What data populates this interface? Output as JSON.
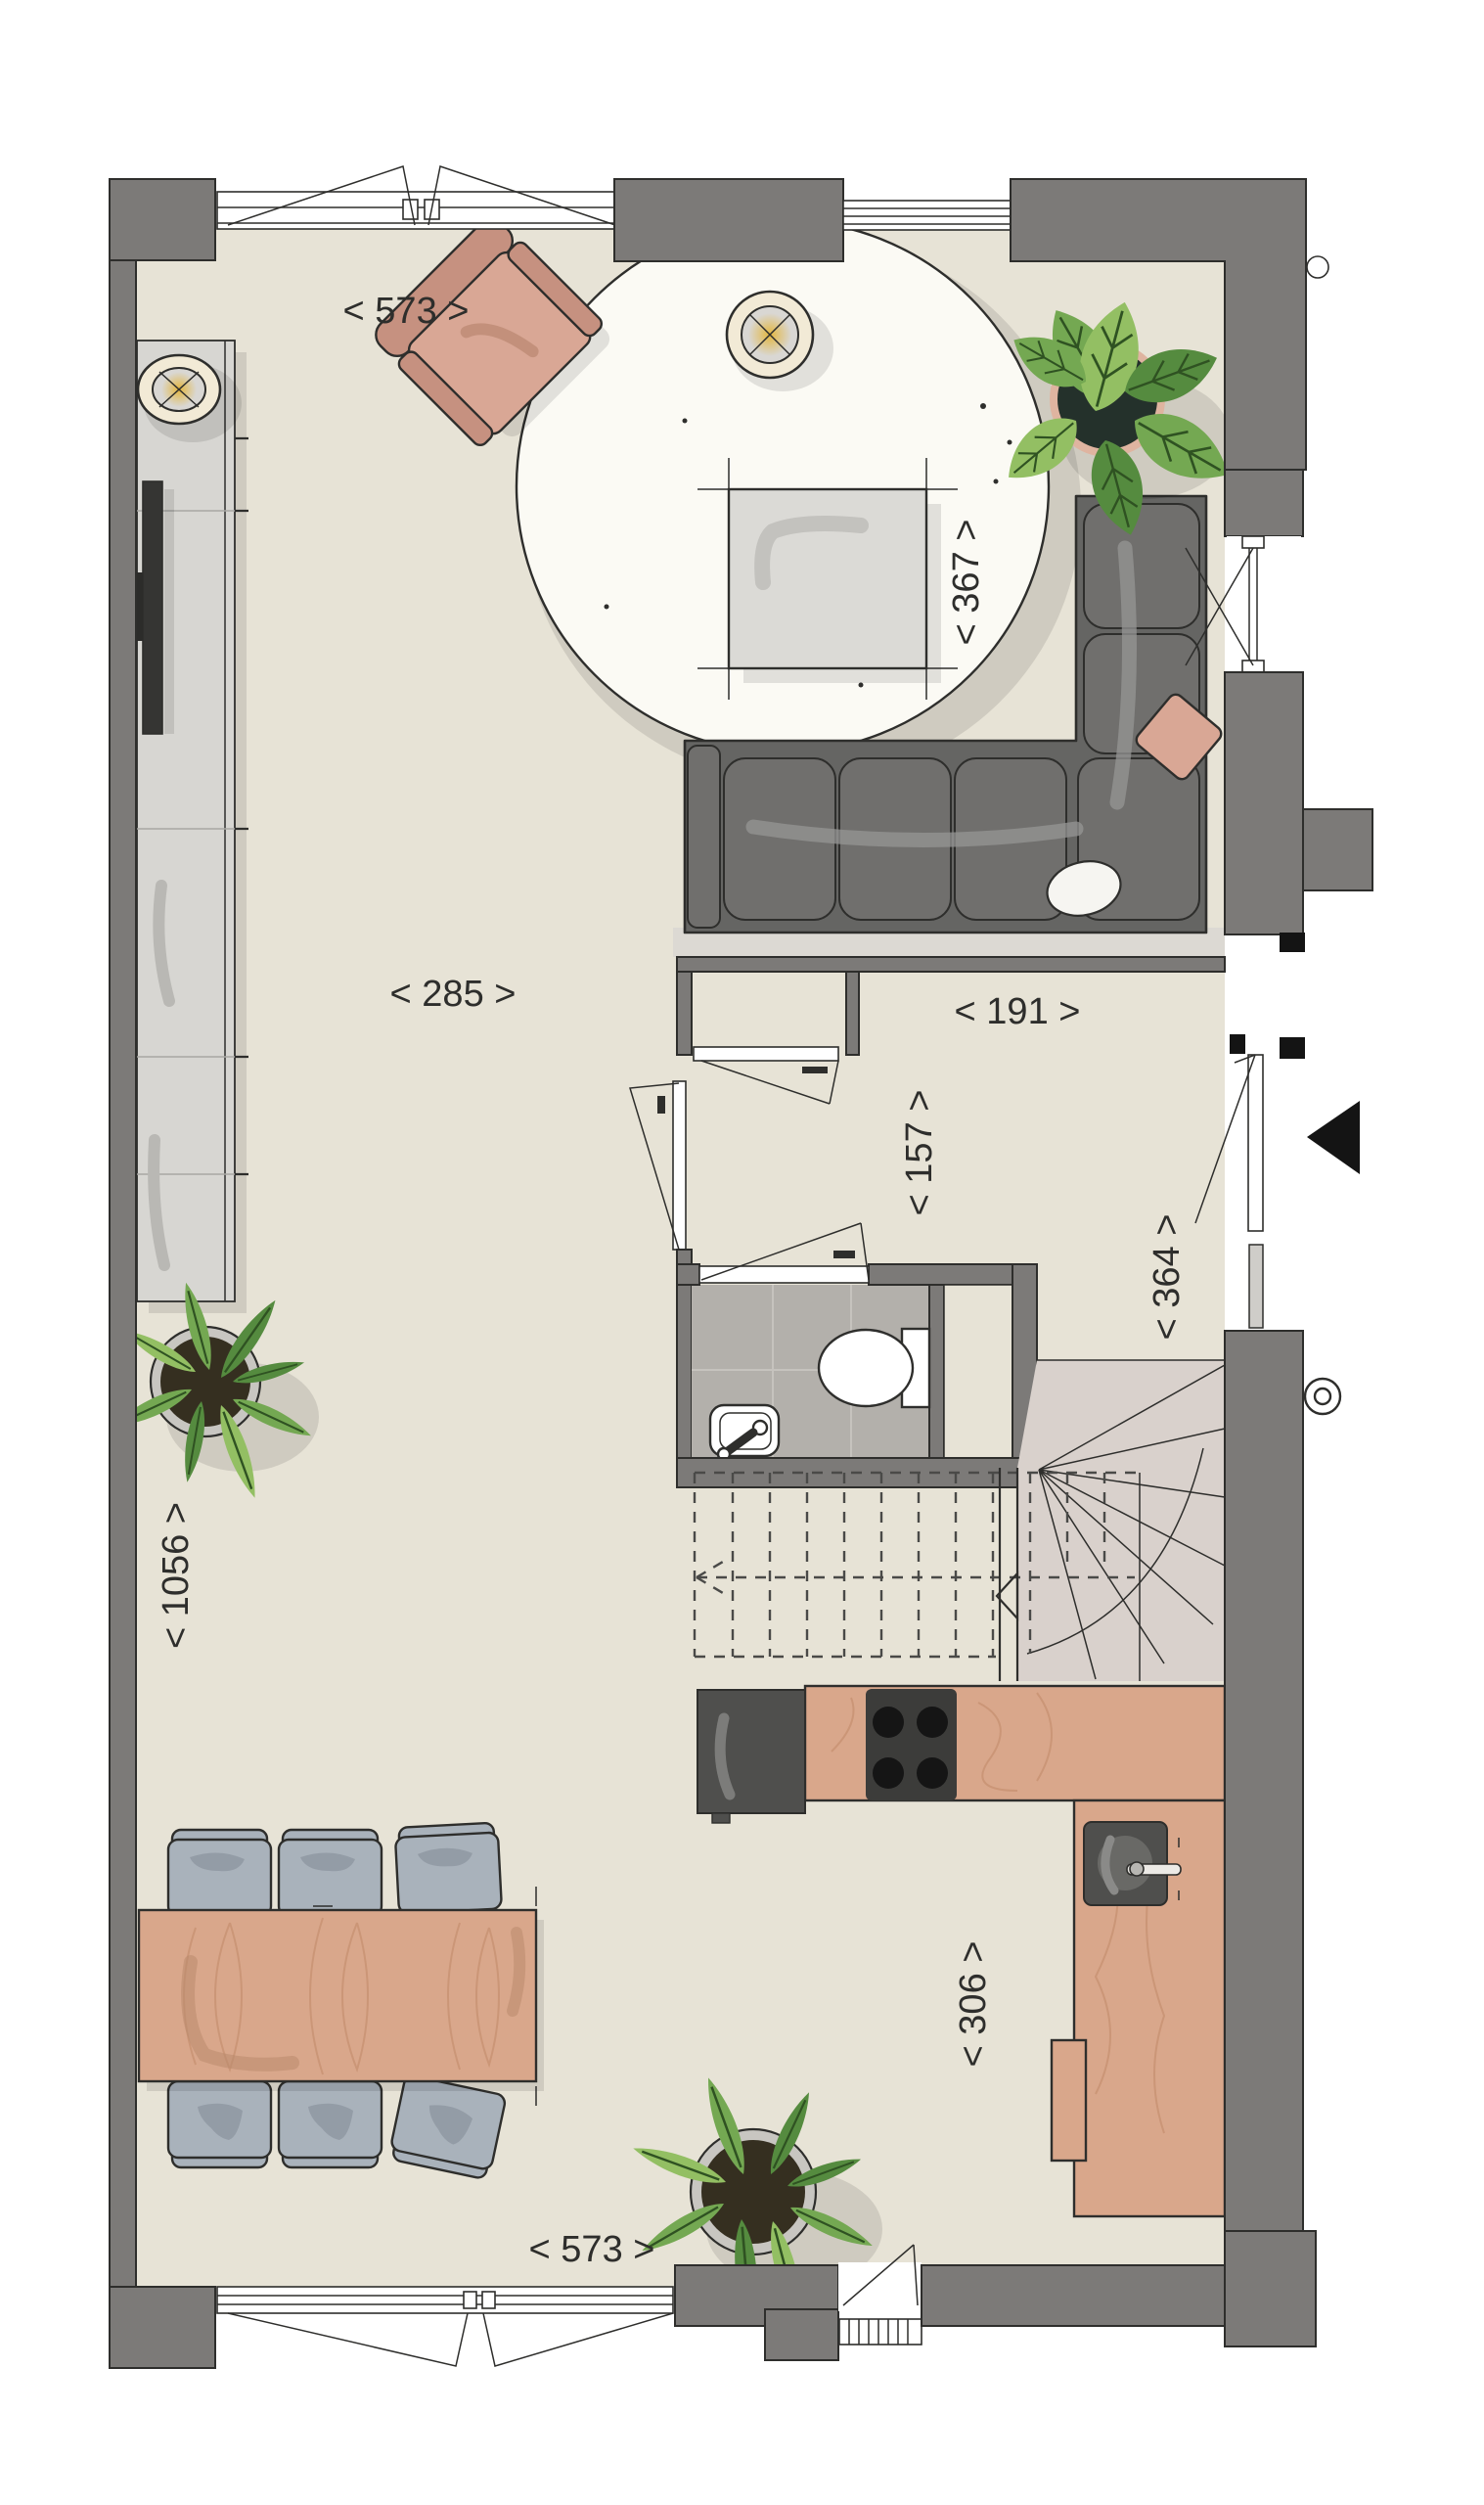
{
  "labels": {
    "top_width": "< 573 >",
    "living_depth": "< 367 >",
    "living_width": "< 285 >",
    "hall_width": "< 191 >",
    "hall_depth": "< 157 >",
    "entry_depth": "< 364 >",
    "total_depth": "< 1056 >",
    "kitchen_depth": "< 306 >",
    "bottom_width": "< 573 >"
  },
  "icons": {
    "entrance_arrow": "left-filled-triangle",
    "stair_direction_arrow": "left-hollow-triangle",
    "lamp_symbol": "circle-with-cross-and-glow"
  },
  "palette": {
    "floor": "#e7e3d6",
    "wall": "#7c7a78",
    "outline": "#2e2e2c",
    "rug": "#fbfaf4",
    "wood": "#d9a78b",
    "woodLine": "#c18a6b",
    "sofa": "#656563",
    "sofaCushion": "#706f6d",
    "sofaHighlight": "#969694",
    "armchair": "#d9a795",
    "armchairDark": "#c69180",
    "chairBlue": "#a9b2bb",
    "chairBlueDark": "#8f98a2",
    "tableGray": "#dbdad6",
    "tableSwoosh": "#c3c2be",
    "cabinet": "#d7d6d2",
    "tv": "#353533",
    "tile": "#b3b0ab",
    "tileLine": "#c6c3be",
    "lampCream": "#f2ead6",
    "lampGlow": "#e3b63e",
    "potDark": "#24312b",
    "potRim": "#dfb4a0",
    "potGray": "#c8c6c1",
    "soil": "#352f20",
    "leaf1": "#558b3f",
    "leaf2": "#74a852",
    "leaf3": "#93bf63",
    "leafDark": "#2f5222",
    "stairTread": "#d9d1cc",
    "dash": "#4a4a48",
    "appliance": "#4f4f4d",
    "black": "#141414"
  }
}
